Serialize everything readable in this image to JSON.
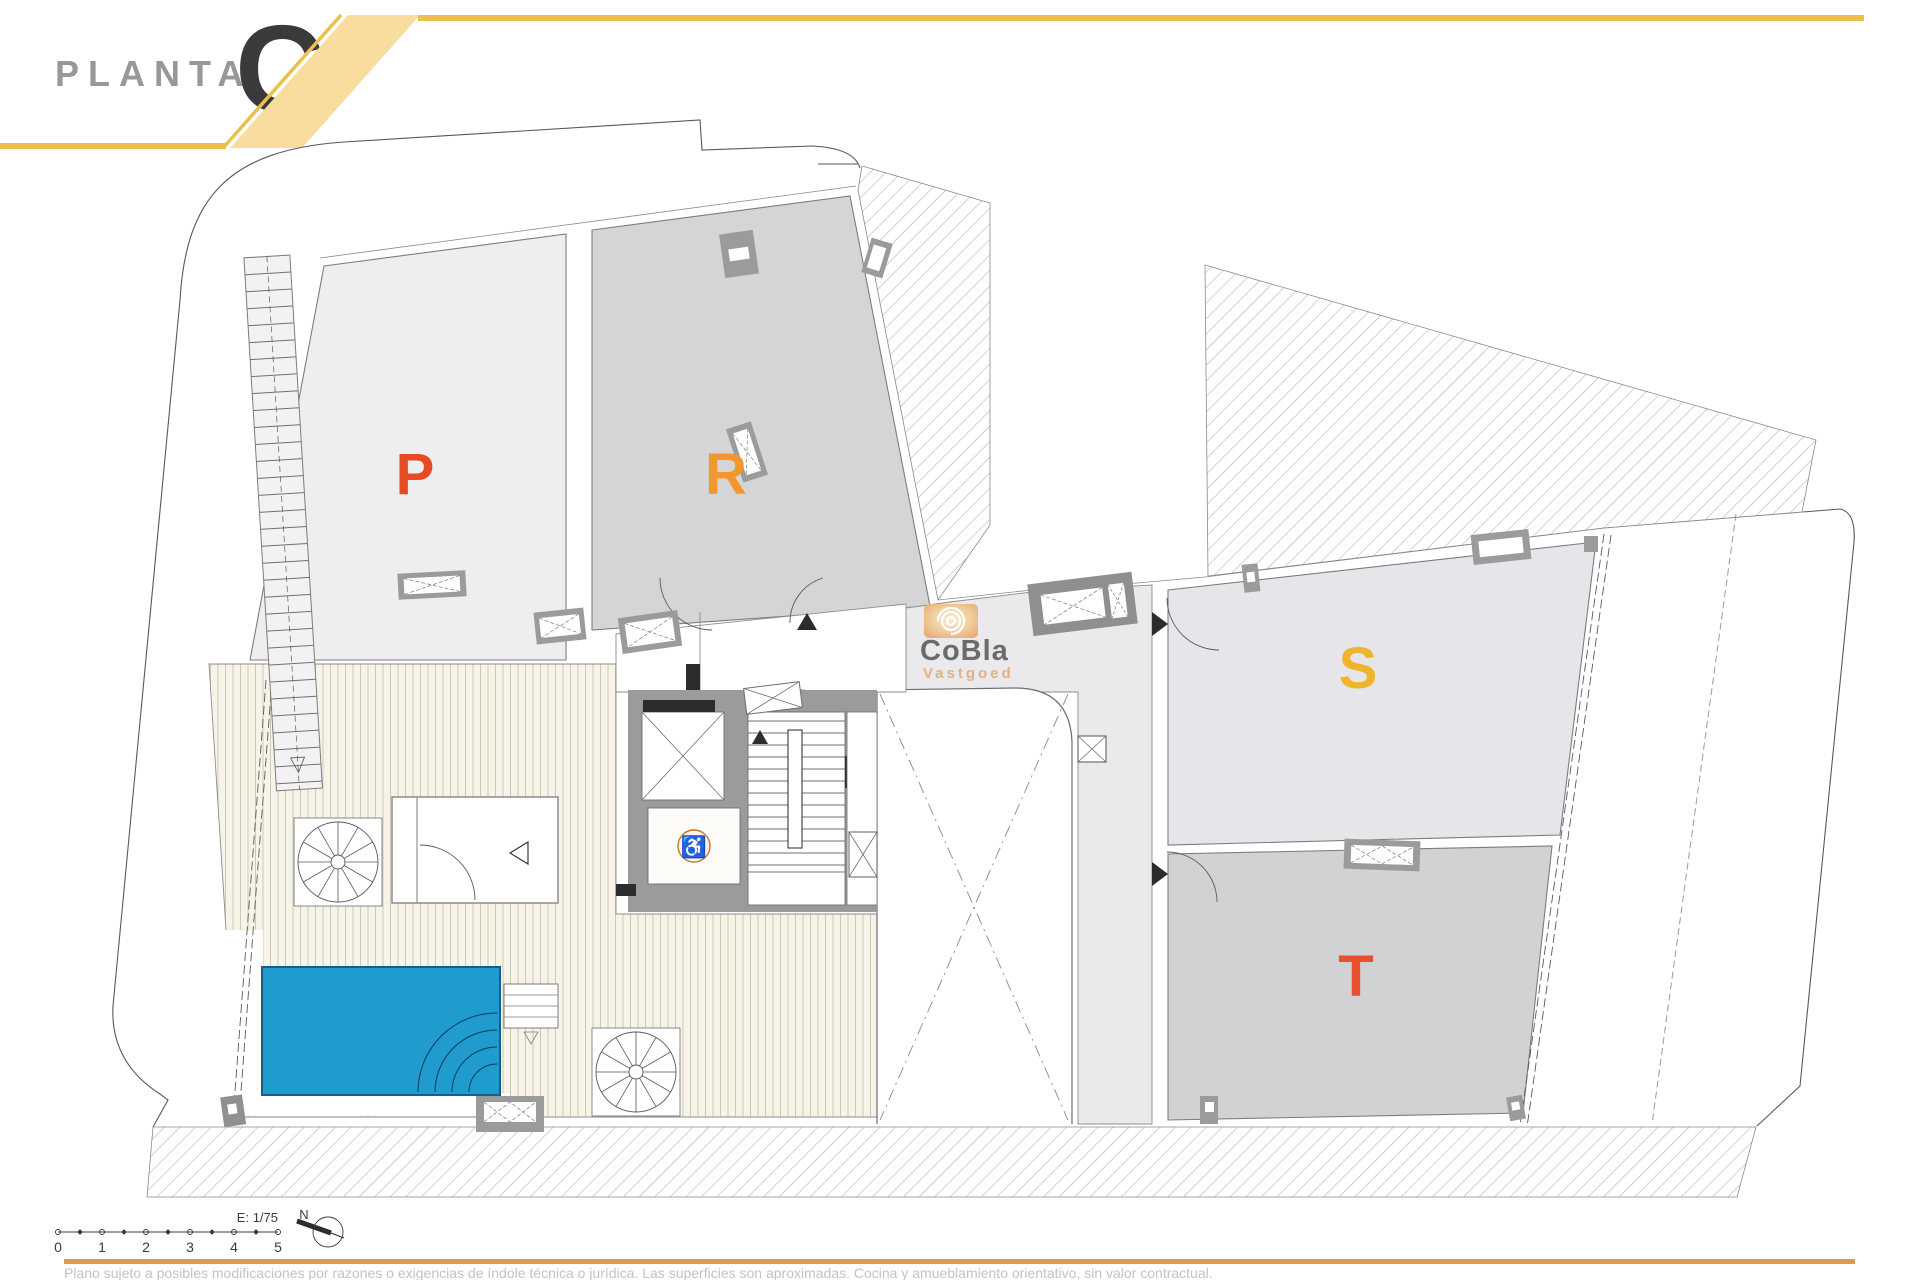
{
  "header": {
    "floor_label": "PLANTA",
    "floor_letter": "C",
    "accent_line_color": "#eac14d",
    "band_fill": "#f8dd9f"
  },
  "logo": {
    "name": "CoBla",
    "subtitle": "Vastgoed",
    "name_color": "#6b6b6d",
    "subtitle_color": "#e2b182",
    "icon": "concentric-spiral-icon"
  },
  "rooms": {
    "p": {
      "label": "P",
      "color": "#e84b23"
    },
    "r": {
      "label": "R",
      "color": "#f2962e"
    },
    "s": {
      "label": "S",
      "color": "#f0b42c"
    },
    "t": {
      "label": "T",
      "color": "#e8502f"
    }
  },
  "plan": {
    "pool_color": "#1f9bce",
    "pool_border_color": "#145e85",
    "room_p_fill": "#eeedef",
    "room_r_fill": "#d5d4d6",
    "room_s_fill": "#e6e6ea",
    "room_t_fill": "#d2d2d4",
    "corridor_fill": "#eae9eb",
    "core_wall_fill": "#9b9b9b",
    "wheelchair_icon": "♿",
    "wheelchair_color": "#c8732c"
  },
  "scale_bar": {
    "ticks": [
      "0",
      "1",
      "2",
      "3",
      "4",
      "5"
    ],
    "scale_text": "E: 1/75",
    "north_label": "N"
  },
  "footer": {
    "disclaimer": "Plano sujeto a posibles modificaciones por razones o exigencias de índole técnica o jurídica. Las superficies son aproximadas. Cocina y amueblamiento orientativo, sin valor contractual."
  }
}
